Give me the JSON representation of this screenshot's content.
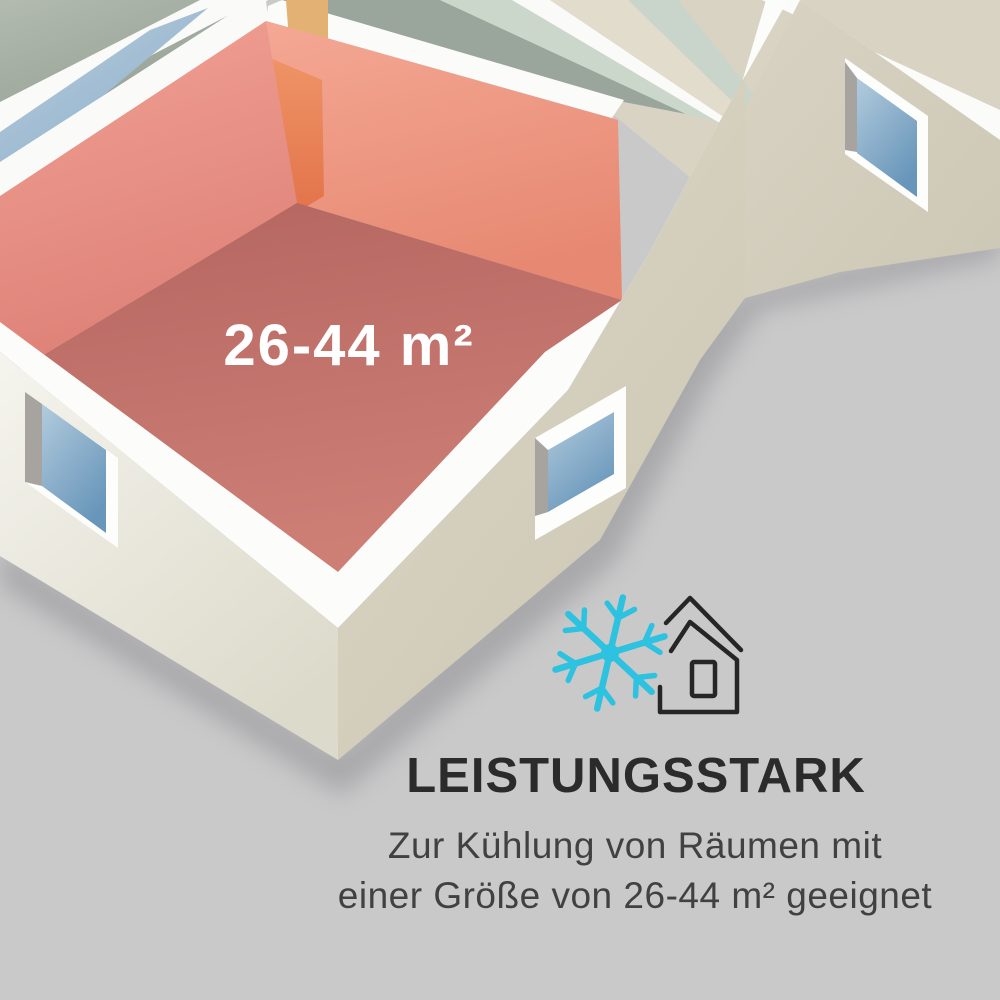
{
  "floor_plan": {
    "type": "isometric-cutaway-floor-plan",
    "highlighted_room": {
      "area_label": "26-44 m²",
      "floor_color": "#c3746c",
      "wall_color": "#ee9a8d",
      "door_color": "#e8834f"
    },
    "other_rooms": {
      "gray_green_floor": "#9aa59b",
      "mint_floor": "#ccd7cc",
      "beige_floor": "#d8d3c2",
      "blue_floor": "#a3bfd6",
      "exterior_wall_white": "#f3f2eb",
      "exterior_wall_cream": "#d9d4c4",
      "window_glass": "#7ea8c6"
    }
  },
  "icons": {
    "snowflake": {
      "name": "snowflake-icon",
      "color": "#2cc2e0"
    },
    "house": {
      "name": "house-icon",
      "color": "#262626"
    }
  },
  "caption": {
    "headline": "LEISTUNGSSTARK",
    "line1": "Zur Kühlung von Räumen mit",
    "line2": "einer Größe von 26-44 m² geeignet"
  },
  "colors": {
    "background": "#c9c9ca",
    "headline_text": "#2b2b2b",
    "body_text": "#414141",
    "accent_cyan": "#2cc2e0",
    "highlight_red": "#e28a80"
  }
}
